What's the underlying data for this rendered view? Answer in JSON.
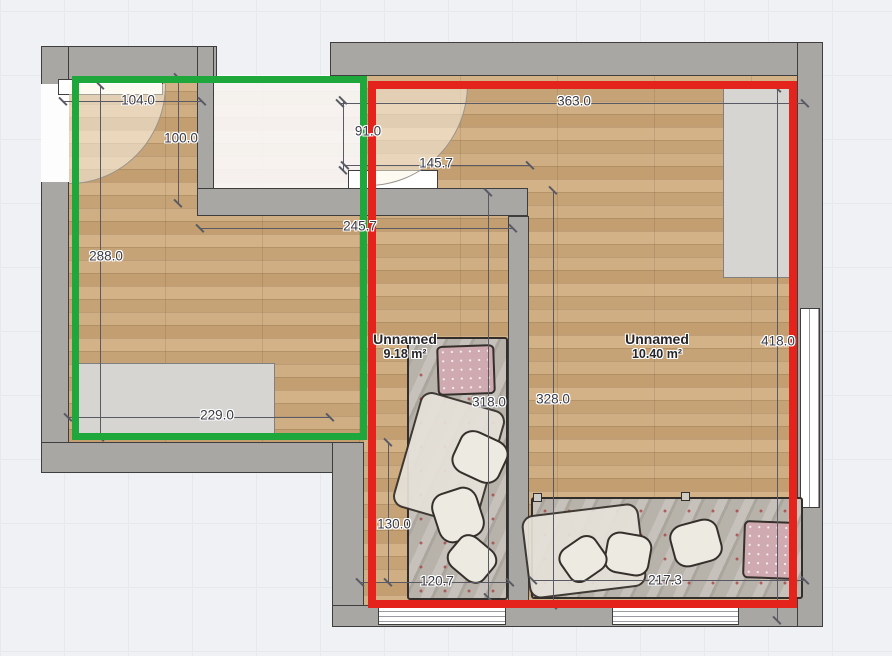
{
  "plan": {
    "rooms": [
      {
        "name": "Unnamed",
        "area": "9.18 m²"
      },
      {
        "name": "Unnamed",
        "area": "10.40 m²"
      }
    ],
    "dimensions": [
      {
        "label": "104.0",
        "x1": 63,
        "y1": 101,
        "x2": 202,
        "y2": 101,
        "lx": 138,
        "ly": 100
      },
      {
        "label": "100.0",
        "x1": 178,
        "y1": 77,
        "x2": 178,
        "y2": 203,
        "lx": 181,
        "ly": 138
      },
      {
        "label": "288.0",
        "x1": 100,
        "y1": 85,
        "x2": 100,
        "y2": 437,
        "lx": 106,
        "ly": 256
      },
      {
        "label": "229.0",
        "x1": 68,
        "y1": 417,
        "x2": 330,
        "y2": 417,
        "lx": 217,
        "ly": 415
      },
      {
        "label": "363.0",
        "x1": 340,
        "y1": 103,
        "x2": 805,
        "y2": 103,
        "lx": 574,
        "ly": 101
      },
      {
        "label": "91.0",
        "x1": 343,
        "y1": 100,
        "x2": 343,
        "y2": 170,
        "lx": 368,
        "ly": 131
      },
      {
        "label": "145.7",
        "x1": 345,
        "y1": 165,
        "x2": 530,
        "y2": 165,
        "lx": 436,
        "ly": 163
      },
      {
        "label": "245.7",
        "x1": 200,
        "y1": 228,
        "x2": 513,
        "y2": 228,
        "lx": 360,
        "ly": 226
      },
      {
        "label": "318.0",
        "x1": 488,
        "y1": 192,
        "x2": 488,
        "y2": 597,
        "lx": 489,
        "ly": 402
      },
      {
        "label": "328.0",
        "x1": 553,
        "y1": 190,
        "x2": 553,
        "y2": 605,
        "lx": 553,
        "ly": 399
      },
      {
        "label": "418.0",
        "x1": 777,
        "y1": 88,
        "x2": 777,
        "y2": 620,
        "lx": 778,
        "ly": 341
      },
      {
        "label": "130.0",
        "x1": 388,
        "y1": 442,
        "x2": 388,
        "y2": 582,
        "lx": 394,
        "ly": 524
      },
      {
        "label": "120.7",
        "x1": 360,
        "y1": 582,
        "x2": 510,
        "y2": 582,
        "lx": 437,
        "ly": 581
      },
      {
        "label": "217.3",
        "x1": 533,
        "y1": 580,
        "x2": 805,
        "y2": 580,
        "lx": 665,
        "ly": 580
      }
    ],
    "selections": [
      {
        "id": "selection-rectangle-green",
        "color": "#1ea83b",
        "x": 72,
        "y": 76,
        "w": 295,
        "h": 364,
        "stroke": 7
      },
      {
        "id": "selection-rectangle-red",
        "color": "#e5231d",
        "x": 368,
        "y": 81,
        "w": 429,
        "h": 527,
        "stroke": 8
      }
    ],
    "colors": {
      "background": "#f0f1f5",
      "grid_line": "#e6e8ee",
      "wall_fill": "#a8a7a4",
      "wall_outline": "#3e3e3e",
      "floor_wood": "#cbaa7f"
    },
    "furniture": [
      {
        "id": "sideboard-left-room"
      },
      {
        "id": "wardrobe-right-room"
      },
      {
        "id": "bed-single-vertical"
      },
      {
        "id": "bed-single-horizontal"
      }
    ],
    "openings": [
      {
        "id": "door-left"
      },
      {
        "id": "door-top-middle"
      },
      {
        "id": "window-top-left"
      },
      {
        "id": "window-middle-wall"
      },
      {
        "id": "window-right-wall"
      },
      {
        "id": "window-bottom-left"
      },
      {
        "id": "window-bottom-right"
      }
    ]
  }
}
